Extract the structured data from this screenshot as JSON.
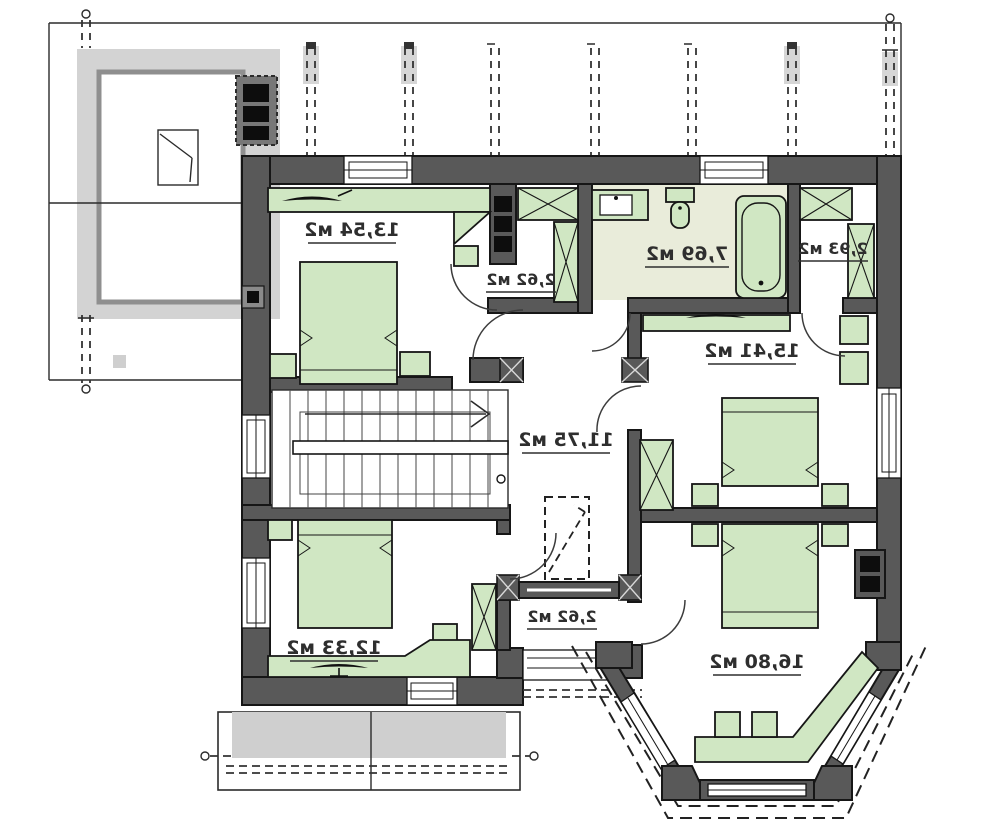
{
  "image": {
    "kind": "attic-floor-plan",
    "width": 1000,
    "height": 822,
    "text_mirrored": true
  },
  "rooms": [
    {
      "name": "bedroom-top-left",
      "area_label": "13,54 м2"
    },
    {
      "name": "wardrobe-top",
      "area_label": "2,62 м2"
    },
    {
      "name": "bathroom",
      "area_label": "7,69 м2"
    },
    {
      "name": "wardrobe-right",
      "area_label": "2,93 м2"
    },
    {
      "name": "bedroom-right",
      "area_label": "15,41 м2"
    },
    {
      "name": "hall-stairs",
      "area_label": "11,75 м2"
    },
    {
      "name": "bedroom-bottom-left",
      "area_label": "12,33 м2"
    },
    {
      "name": "balcony",
      "area_label": "2,62 м2"
    },
    {
      "name": "bedroom-bay",
      "area_label": "16,80 м2"
    }
  ],
  "colors": {
    "wall": "#595959",
    "furniture": "#d0e7c3",
    "bathroom_floor": "#e9ecda",
    "roof_gray": "#d3d3d3",
    "outline": "#161616"
  }
}
